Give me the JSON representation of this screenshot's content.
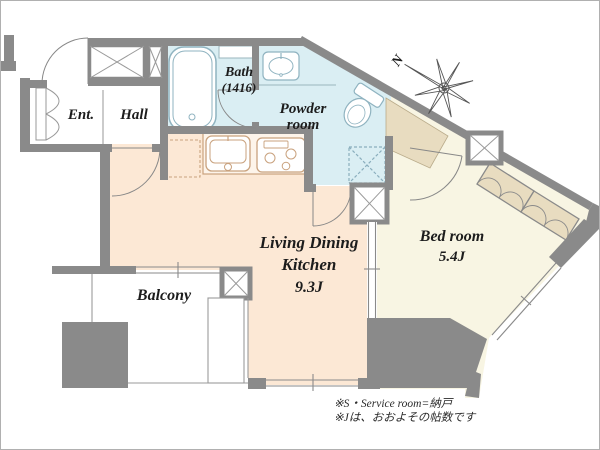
{
  "title": "Apartment floor plan",
  "rooms": {
    "entrance": {
      "label": "Ent."
    },
    "hall": {
      "label": "Hall"
    },
    "bath": {
      "label": "Bath",
      "size": "(1416)"
    },
    "powder_room": {
      "label_line1": "Powder",
      "label_line2": "room"
    },
    "ldk": {
      "label_line1": "Living Dining",
      "label_line2": "Kitchen",
      "size": "9.3J"
    },
    "bedroom": {
      "label": "Bed room",
      "size": "5.4J"
    },
    "balcony": {
      "label": "Balcony"
    }
  },
  "compass": {
    "label": "N"
  },
  "notes": {
    "line1": "※S・Service room=納戸",
    "line2": "※Jは、おおよその帖数です"
  },
  "colors": {
    "wall": "#8a8a8a",
    "bath_floor": "#daeef3",
    "ldk_floor": "#fce8d5",
    "bedroom_floor": "#f8f5e3",
    "closet_fill": "#e8dcc0",
    "fixture_outline": "#8fb3c0",
    "kitchen_outline": "#c9a27e"
  },
  "fixtures": [
    "bathtub",
    "washbasin",
    "toilet",
    "kitchen-sink",
    "stove",
    "refrigerator-space",
    "washing-machine-space",
    "shoe-cabinet",
    "folding-closet",
    "pipe-space",
    "compass-rose"
  ]
}
